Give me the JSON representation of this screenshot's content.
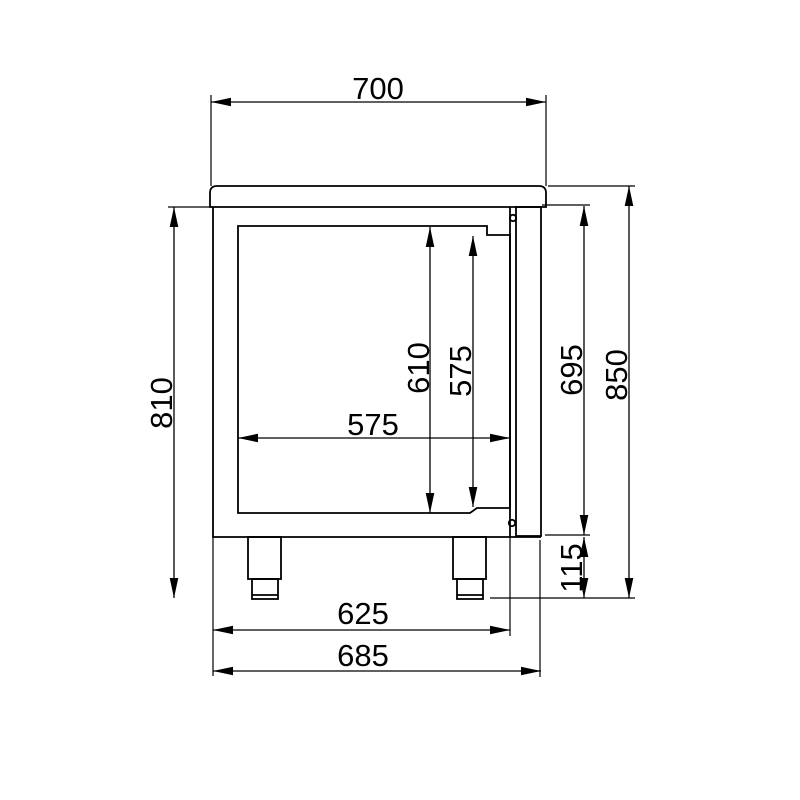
{
  "drawing": {
    "kind": "technical-side-view",
    "dims": {
      "top_width": "700",
      "left_height": "810",
      "inner_height": "610",
      "door_opening_height": "575",
      "inner_depth": "575",
      "right_body_height": "695",
      "overall_height": "850",
      "leg_height": "115",
      "body_depth": "625",
      "overall_depth": "685"
    },
    "colors": {
      "line": "#000000",
      "background": "#ffffff"
    }
  }
}
